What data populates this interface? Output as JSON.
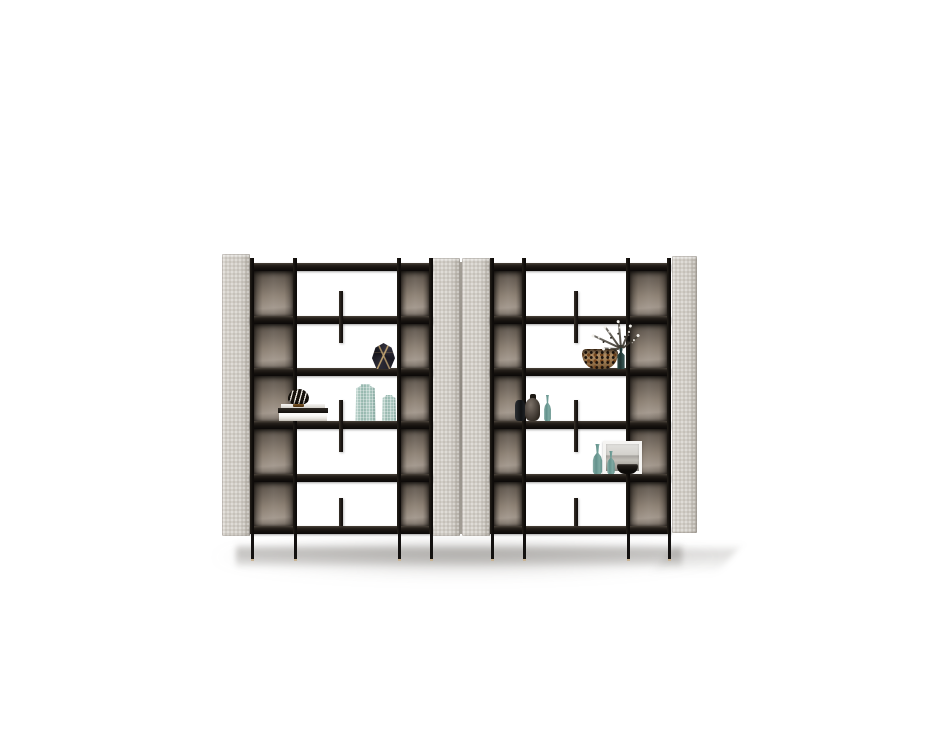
{
  "scene": {
    "label": "Studio product photograph of two modern modular bookshelf units with black metal frames, taupe upholstered side panels, smoked bronze back panels and decorative vases, books, bowls and dried flowers",
    "background": "#ffffff",
    "colors": {
      "background": "#ffffff",
      "panel_taupe": "#d0ccc5",
      "panel_edge": "#a29d95",
      "frame_black": "#15110e",
      "shelf_front": "#1c1712",
      "bronze_dark": "#554d44",
      "bronze_light": "#a0958a",
      "brass_foot": "#c9b494",
      "teal_glass": "#6f9a94",
      "teal_ribbed": "#a5c4bb",
      "gold_accent": "#b99a6b",
      "floor_shadow": "#6c6862"
    },
    "shelf_tops": [
      263,
      316,
      368,
      421,
      474,
      526
    ],
    "shelf_h": 8,
    "units": [
      {
        "name": "bookshelf-left",
        "frame": {
          "x": 250,
          "w": 183,
          "posts": [
            250,
            293,
            397,
            429
          ],
          "post_w": 4,
          "top": 258,
          "legs_bottom": 561
        },
        "side_panels": [
          {
            "name": "side-panel-outer-left",
            "x": 222,
            "y": 254,
            "w": 28,
            "h": 282
          },
          {
            "name": "side-panel-inner-right",
            "x": 432,
            "y": 258,
            "w": 28,
            "h": 278
          }
        ],
        "back_cols": [
          [
            254,
            39
          ],
          [
            401,
            28
          ]
        ],
        "tabs": [
          {
            "x": 339,
            "y": 291,
            "w": 4,
            "h": 52
          },
          {
            "x": 339,
            "y": 400,
            "w": 4,
            "h": 52
          },
          {
            "x": 339,
            "y": 498,
            "w": 4,
            "h": 28
          }
        ],
        "decor": [
          {
            "kind": "books",
            "name": "book-stack",
            "x": 278,
            "y": 404,
            "w": 50,
            "h": 17
          },
          {
            "kind": "zebra",
            "name": "beaded-ornament",
            "x": 288,
            "y": 389,
            "w": 21,
            "h": 16
          },
          {
            "kind": "facet",
            "name": "faceted-vase",
            "x": 372,
            "y": 343,
            "w": 23,
            "h": 26
          },
          {
            "kind": "rib",
            "name": "ribbed-vase-large",
            "x": 354,
            "y": 384,
            "w": 23,
            "h": 37
          },
          {
            "kind": "rib",
            "name": "ribbed-vase-small",
            "x": 381,
            "y": 395,
            "w": 16,
            "h": 26
          }
        ]
      },
      {
        "name": "bookshelf-right",
        "frame": {
          "x": 490,
          "w": 181,
          "posts": [
            490,
            522,
            626,
            667
          ],
          "post_w": 4,
          "top": 258,
          "legs_bottom": 561
        },
        "side_panels": [
          {
            "name": "side-panel-inner-left",
            "x": 462,
            "y": 258,
            "w": 28,
            "h": 278
          },
          {
            "name": "side-panel-outer-right",
            "x": 672,
            "y": 256,
            "w": 25,
            "h": 277
          }
        ],
        "back_cols": [
          [
            494,
            28
          ],
          [
            630,
            37
          ]
        ],
        "tabs": [
          {
            "x": 574,
            "y": 291,
            "w": 4,
            "h": 52
          },
          {
            "x": 574,
            "y": 400,
            "w": 4,
            "h": 52
          },
          {
            "x": 574,
            "y": 498,
            "w": 4,
            "h": 28
          }
        ],
        "decor": [
          {
            "kind": "leopard",
            "name": "leopard-bowl",
            "x": 582,
            "y": 349,
            "w": 36,
            "h": 20
          },
          {
            "kind": "glassdark",
            "name": "flower-vase",
            "x": 615,
            "y": 345,
            "w": 12,
            "h": 24
          },
          {
            "kind": "sprig",
            "name": "flower-sprig",
            "x": 620,
            "y": 347,
            "w": 30,
            "h": 2,
            "rot": -155
          },
          {
            "kind": "sprig",
            "name": "flower-sprig",
            "x": 620,
            "y": 347,
            "w": 26,
            "h": 2,
            "rot": -125
          },
          {
            "kind": "sprig",
            "name": "flower-sprig",
            "x": 621,
            "y": 347,
            "w": 27,
            "h": 2,
            "rot": -95
          },
          {
            "kind": "sprig",
            "name": "flower-sprig",
            "x": 622,
            "y": 347,
            "w": 24,
            "h": 2,
            "rot": -68
          },
          {
            "kind": "sprig",
            "name": "flower-sprig",
            "x": 623,
            "y": 347,
            "w": 20,
            "h": 2,
            "rot": -38
          },
          {
            "kind": "sprig",
            "name": "flower-sprig",
            "x": 619,
            "y": 348,
            "w": 16,
            "h": 2,
            "rot": -178
          },
          {
            "kind": "vasedarksm",
            "name": "dark-vase-small",
            "x": 515,
            "y": 400,
            "w": 10,
            "h": 21
          },
          {
            "kind": "vasedark",
            "name": "dark-vase-large",
            "x": 525,
            "y": 394,
            "w": 15,
            "h": 27
          },
          {
            "kind": "bottle",
            "name": "teal-bottle-vase",
            "x": 542,
            "y": 395,
            "w": 11,
            "h": 26
          },
          {
            "kind": "frame",
            "name": "picture-frame",
            "x": 603,
            "y": 441,
            "w": 39,
            "h": 33
          },
          {
            "kind": "bottle",
            "name": "teal-bottle-tall",
            "x": 590,
            "y": 444,
            "w": 15,
            "h": 30
          },
          {
            "kind": "bottle",
            "name": "teal-bottle-small",
            "x": 605,
            "y": 451,
            "w": 12,
            "h": 23
          },
          {
            "kind": "bowldark",
            "name": "dark-bowl",
            "x": 617,
            "y": 464,
            "w": 21,
            "h": 10
          }
        ]
      }
    ],
    "extras": [
      {
        "cls": "shadow-soft",
        "name": "floor-shadow-soft",
        "x": 212,
        "y": 540,
        "w": 506,
        "h": 38
      },
      {
        "cls": "shadow-band",
        "name": "floor-shadow-band",
        "x": 236,
        "y": 543,
        "w": 446,
        "h": 26
      },
      {
        "cls": "shadow-spill",
        "name": "floor-shadow-spill",
        "x": 662,
        "y": 549,
        "w": 66,
        "h": 24
      },
      {
        "cls": "panel-seam",
        "name": "panel-seam",
        "x": 460,
        "y": 262,
        "w": 2,
        "h": 272
      }
    ]
  }
}
